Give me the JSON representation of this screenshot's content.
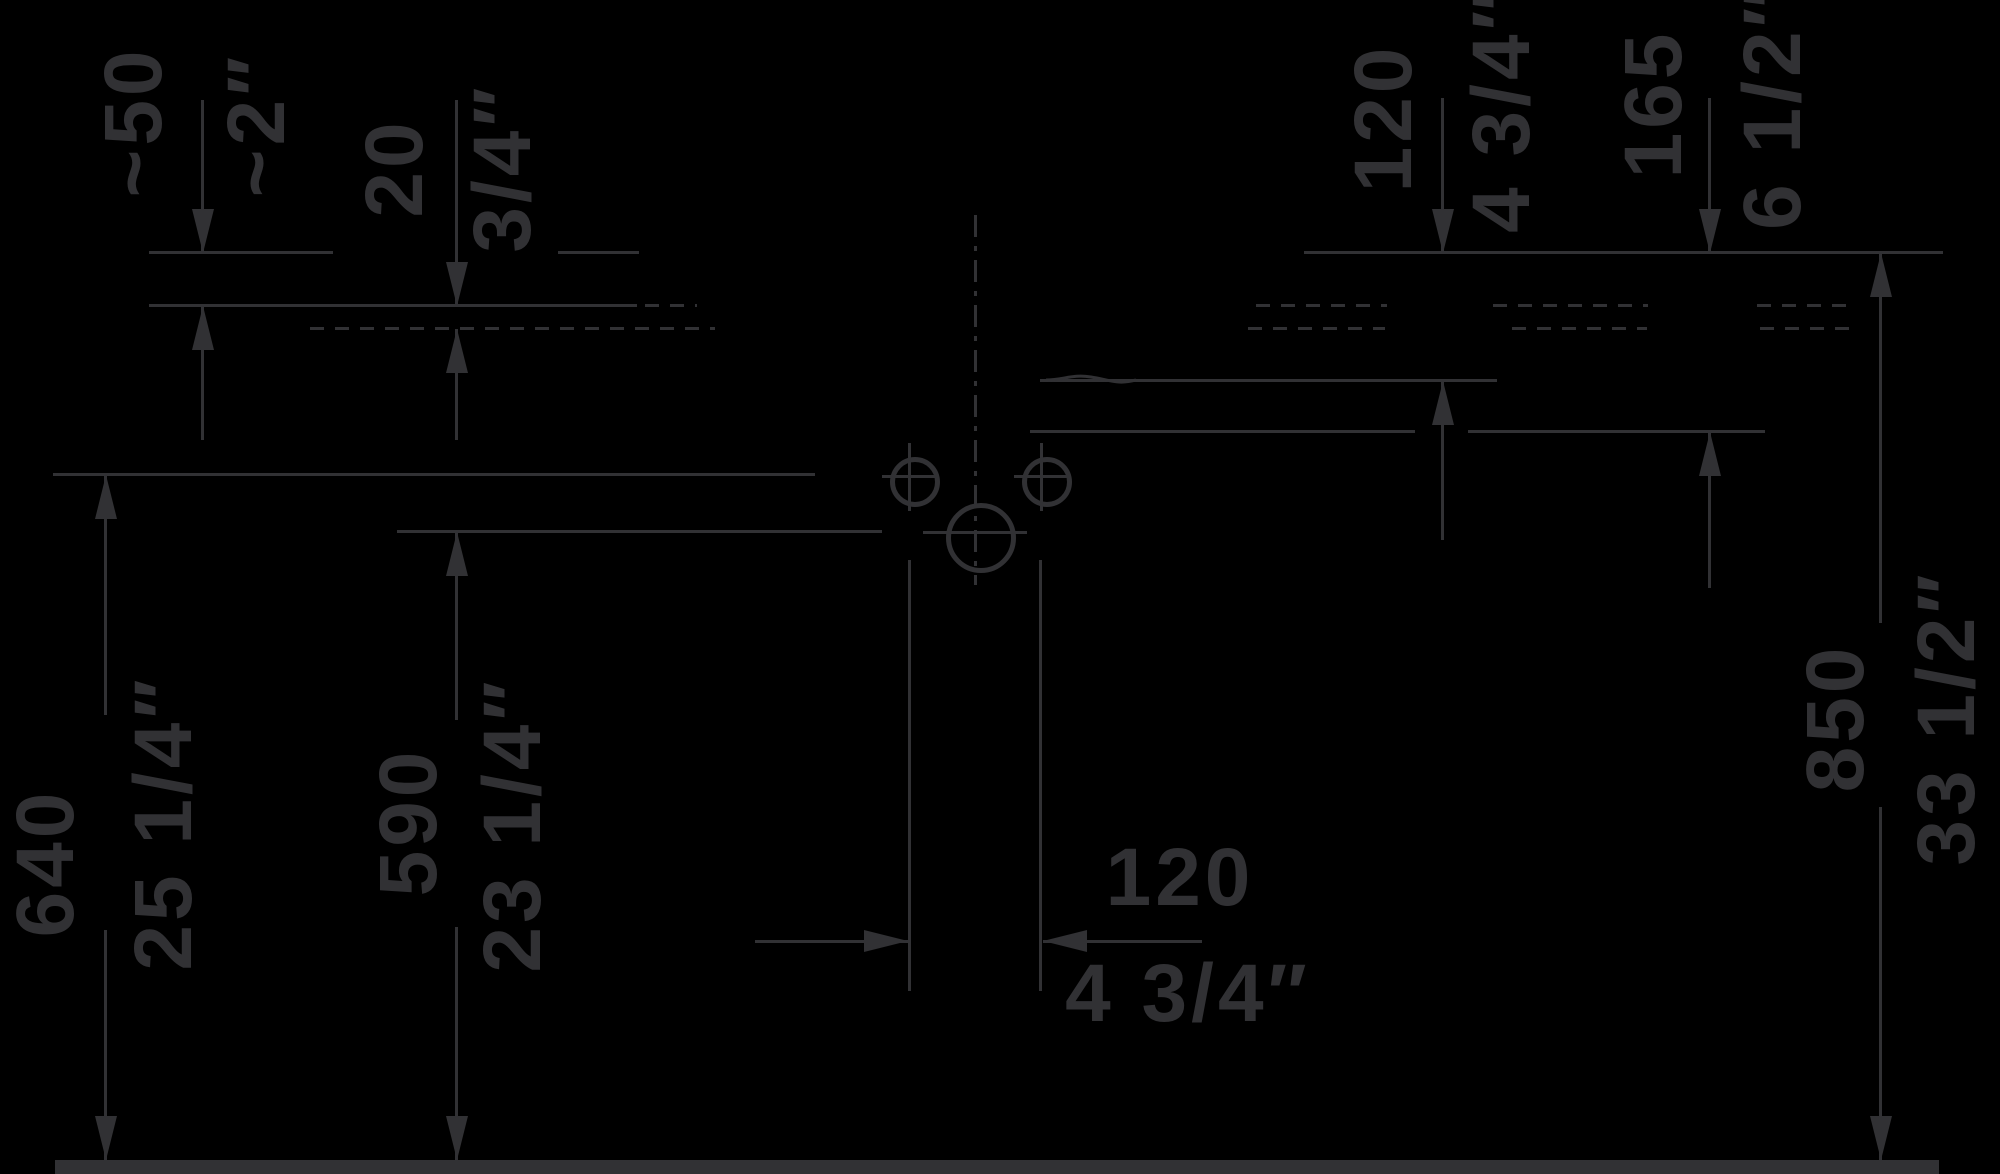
{
  "colors": {
    "background": "#000000",
    "ink": "#313134"
  },
  "dimensions": [
    {
      "id": "dim-50",
      "mm": "~50",
      "inch": "~2″",
      "orientation": "vertical"
    },
    {
      "id": "dim-20",
      "mm": "20",
      "inch": "3/4″",
      "orientation": "vertical"
    },
    {
      "id": "dim-120-top",
      "mm": "120",
      "inch": "4 3/4″",
      "orientation": "vertical"
    },
    {
      "id": "dim-165",
      "mm": "165",
      "inch": "6 1/2″",
      "orientation": "vertical"
    },
    {
      "id": "dim-640",
      "mm": "640",
      "inch": "25 1/4″",
      "orientation": "vertical"
    },
    {
      "id": "dim-590",
      "mm": "590",
      "inch": "23 1/4″",
      "orientation": "vertical"
    },
    {
      "id": "dim-850",
      "mm": "850",
      "inch": "33 1/2″",
      "orientation": "vertical"
    },
    {
      "id": "dim-120-bottom",
      "mm": "120",
      "inch": "4 3/4″",
      "orientation": "horizontal"
    }
  ]
}
